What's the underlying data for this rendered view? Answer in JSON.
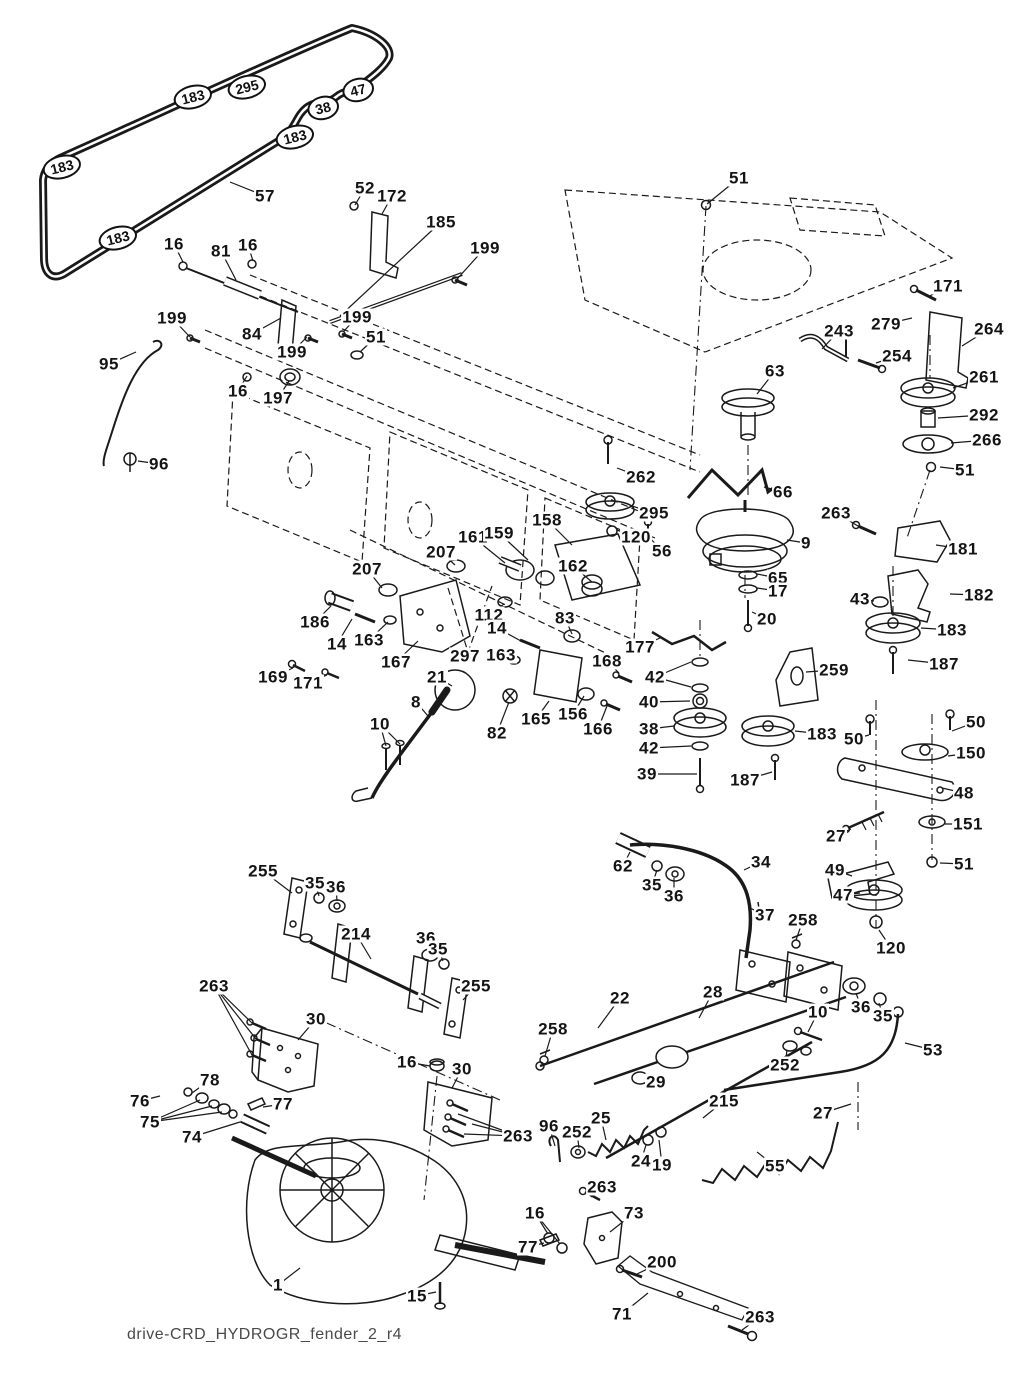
{
  "footer_text": "drive-CRD_HYDROGR_fender_2_r4",
  "colors": {
    "ink": "#1a1a1a",
    "label": "#141414",
    "footer": "#4a4a4a",
    "background": "#ffffff"
  },
  "diagram": {
    "belt_badges": [
      {
        "t": "183",
        "x": 193,
        "y": 97
      },
      {
        "t": "295",
        "x": 247,
        "y": 87
      },
      {
        "t": "47",
        "x": 358,
        "y": 90
      },
      {
        "t": "38",
        "x": 323,
        "y": 108
      },
      {
        "t": "183",
        "x": 295,
        "y": 137
      },
      {
        "t": "183",
        "x": 62,
        "y": 167
      },
      {
        "t": "183",
        "x": 118,
        "y": 238
      }
    ],
    "part_labels": [
      {
        "t": "57",
        "x": 265,
        "y": 196,
        "l": [
          230,
          182
        ]
      },
      {
        "t": "52",
        "x": 365,
        "y": 188,
        "l": [
          355,
          205
        ]
      },
      {
        "t": "172",
        "x": 392,
        "y": 196,
        "l": [
          382,
          214
        ]
      },
      {
        "t": "185",
        "x": 441,
        "y": 222,
        "l": [
          340,
          316
        ]
      },
      {
        "t": "199",
        "x": 485,
        "y": 248,
        "l": [
          458,
          278
        ]
      },
      {
        "t": "51",
        "x": 739,
        "y": 178,
        "l": [
          707,
          204
        ]
      },
      {
        "t": "16",
        "x": 174,
        "y": 244,
        "l": [
          183,
          262
        ]
      },
      {
        "t": "81",
        "x": 221,
        "y": 251,
        "l": [
          236,
          280
        ]
      },
      {
        "t": "16",
        "x": 248,
        "y": 245,
        "l": [
          253,
          261
        ]
      },
      {
        "t": "199",
        "x": 172,
        "y": 318,
        "l": [
          190,
          337
        ]
      },
      {
        "t": "84",
        "x": 252,
        "y": 334,
        "l": [
          281,
          318
        ]
      },
      {
        "t": "199",
        "x": 292,
        "y": 352,
        "l": [
          307,
          337
        ]
      },
      {
        "t": "199",
        "x": 357,
        "y": 317,
        "l": [
          344,
          331
        ]
      },
      {
        "t": "51",
        "x": 376,
        "y": 337,
        "l": [
          360,
          352
        ]
      },
      {
        "t": "95",
        "x": 109,
        "y": 364,
        "l": [
          136,
          352
        ]
      },
      {
        "t": "16",
        "x": 238,
        "y": 391,
        "l": [
          247,
          376
        ]
      },
      {
        "t": "197",
        "x": 278,
        "y": 398,
        "l": [
          289,
          381
        ]
      },
      {
        "t": "96",
        "x": 159,
        "y": 464,
        "l": [
          138,
          461
        ]
      },
      {
        "t": "171",
        "x": 948,
        "y": 286,
        "l": [
          928,
          297
        ]
      },
      {
        "t": "279",
        "x": 886,
        "y": 324,
        "l": [
          912,
          318
        ]
      },
      {
        "t": "264",
        "x": 989,
        "y": 329,
        "l": [
          962,
          346
        ]
      },
      {
        "t": "243",
        "x": 839,
        "y": 331,
        "l": [
          822,
          349
        ]
      },
      {
        "t": "254",
        "x": 897,
        "y": 356,
        "l": [
          876,
          363
        ]
      },
      {
        "t": "63",
        "x": 775,
        "y": 371,
        "l": [
          757,
          394
        ]
      },
      {
        "t": "261",
        "x": 984,
        "y": 377,
        "l": [
          953,
          388
        ]
      },
      {
        "t": "292",
        "x": 984,
        "y": 415,
        "l": [
          938,
          418
        ]
      },
      {
        "t": "266",
        "x": 987,
        "y": 440,
        "l": [
          951,
          443
        ]
      },
      {
        "t": "51",
        "x": 965,
        "y": 470,
        "l": [
          940,
          467
        ]
      },
      {
        "t": "262",
        "x": 641,
        "y": 477,
        "l": [
          617,
          468
        ]
      },
      {
        "t": "295",
        "x": 654,
        "y": 513,
        "l": [
          632,
          506
        ]
      },
      {
        "t": "120",
        "x": 636,
        "y": 537,
        "l": [
          617,
          530
        ]
      },
      {
        "t": "56",
        "x": 662,
        "y": 551,
        "l": [
          649,
          537
        ]
      },
      {
        "t": "66",
        "x": 783,
        "y": 492,
        "l": [
          764,
          487
        ]
      },
      {
        "t": "9",
        "x": 806,
        "y": 543,
        "l": [
          787,
          540
        ]
      },
      {
        "t": "263",
        "x": 836,
        "y": 513,
        "l": [
          858,
          526
        ]
      },
      {
        "t": "181",
        "x": 963,
        "y": 549,
        "l": [
          936,
          545
        ]
      },
      {
        "t": "65",
        "x": 778,
        "y": 578,
        "l": [
          757,
          574
        ]
      },
      {
        "t": "17",
        "x": 778,
        "y": 591,
        "l": [
          757,
          588
        ]
      },
      {
        "t": "20",
        "x": 767,
        "y": 619,
        "l": [
          752,
          612
        ]
      },
      {
        "t": "43",
        "x": 860,
        "y": 599,
        "l": [
          874,
          601
        ]
      },
      {
        "t": "182",
        "x": 979,
        "y": 595,
        "l": [
          950,
          594
        ]
      },
      {
        "t": "183",
        "x": 952,
        "y": 630,
        "l": [
          921,
          628
        ]
      },
      {
        "t": "187",
        "x": 944,
        "y": 664,
        "l": [
          908,
          660
        ]
      },
      {
        "t": "158",
        "x": 547,
        "y": 520,
        "l": [
          572,
          545
        ]
      },
      {
        "t": "161",
        "x": 473,
        "y": 537,
        "l": [
          505,
          563
        ]
      },
      {
        "t": "159",
        "x": 499,
        "y": 533,
        "l": [
          528,
          560
        ]
      },
      {
        "t": "207",
        "x": 441,
        "y": 552,
        "l": [
          455,
          565
        ]
      },
      {
        "t": "162",
        "x": 573,
        "y": 566,
        "l": [
          592,
          582
        ]
      },
      {
        "t": "207",
        "x": 367,
        "y": 569,
        "l": [
          382,
          588
        ]
      },
      {
        "t": "186",
        "x": 315,
        "y": 622,
        "l": [
          331,
          606
        ]
      },
      {
        "t": "14",
        "x": 337,
        "y": 644,
        "l": [
          352,
          619
        ]
      },
      {
        "t": "163",
        "x": 369,
        "y": 640,
        "l": [
          388,
          622
        ]
      },
      {
        "t": "167",
        "x": 396,
        "y": 662,
        "l": [
          418,
          641
        ]
      },
      {
        "t": "297",
        "x": 465,
        "y": 656
      },
      {
        "t": "112",
        "x": 489,
        "y": 615,
        "l": [
          504,
          604
        ]
      },
      {
        "t": "14",
        "x": 497,
        "y": 628,
        "l": [
          521,
          641
        ]
      },
      {
        "t": "163",
        "x": 501,
        "y": 655,
        "l": [
          516,
          660
        ]
      },
      {
        "t": "83",
        "x": 565,
        "y": 618,
        "l": [
          572,
          634
        ]
      },
      {
        "t": "169",
        "x": 273,
        "y": 677,
        "l": [
          293,
          668
        ]
      },
      {
        "t": "171",
        "x": 308,
        "y": 683,
        "l": [
          327,
          675
        ]
      },
      {
        "t": "21",
        "x": 437,
        "y": 677,
        "l": [
          452,
          686
        ]
      },
      {
        "t": "8",
        "x": 416,
        "y": 702,
        "l": [
          428,
          716
        ]
      },
      {
        "t": "10",
        "x": 380,
        "y": 724,
        "l": [
          [
            386,
            746
          ],
          [
            400,
            744
          ]
        ]
      },
      {
        "t": "82",
        "x": 497,
        "y": 733,
        "l": [
          509,
          702
        ]
      },
      {
        "t": "165",
        "x": 536,
        "y": 719,
        "l": [
          549,
          701
        ]
      },
      {
        "t": "156",
        "x": 573,
        "y": 714,
        "l": [
          584,
          696
        ]
      },
      {
        "t": "166",
        "x": 598,
        "y": 729,
        "l": [
          607,
          706
        ]
      },
      {
        "t": "168",
        "x": 607,
        "y": 661,
        "l": [
          619,
          673
        ]
      },
      {
        "t": "177",
        "x": 640,
        "y": 647,
        "l": [
          660,
          638
        ]
      },
      {
        "t": "42",
        "x": 655,
        "y": 677,
        "l": [
          [
            691,
            662
          ],
          [
            691,
            687
          ]
        ]
      },
      {
        "t": "40",
        "x": 649,
        "y": 702,
        "l": [
          690,
          701
        ]
      },
      {
        "t": "38",
        "x": 649,
        "y": 729,
        "l": [
          674,
          726
        ]
      },
      {
        "t": "42",
        "x": 649,
        "y": 748,
        "l": [
          691,
          746
        ]
      },
      {
        "t": "39",
        "x": 647,
        "y": 774,
        "l": [
          697,
          774
        ]
      },
      {
        "t": "259",
        "x": 834,
        "y": 670,
        "l": [
          806,
          672
        ]
      },
      {
        "t": "183",
        "x": 822,
        "y": 734,
        "l": [
          795,
          731
        ]
      },
      {
        "t": "187",
        "x": 745,
        "y": 780,
        "l": [
          772,
          772
        ]
      },
      {
        "t": "50",
        "x": 854,
        "y": 739,
        "l": [
          869,
          735
        ]
      },
      {
        "t": "50",
        "x": 976,
        "y": 722,
        "l": [
          952,
          731
        ]
      },
      {
        "t": "150",
        "x": 971,
        "y": 753,
        "l": [
          948,
          756
        ]
      },
      {
        "t": "48",
        "x": 964,
        "y": 793,
        "l": [
          942,
          788
        ]
      },
      {
        "t": "27",
        "x": 836,
        "y": 836,
        "l": [
          851,
          829
        ]
      },
      {
        "t": "151",
        "x": 968,
        "y": 824,
        "l": [
          945,
          824
        ]
      },
      {
        "t": "49",
        "x": 835,
        "y": 870,
        "l": [
          852,
          876
        ]
      },
      {
        "t": "47",
        "x": 843,
        "y": 895,
        "l": [
          860,
          893
        ]
      },
      {
        "t": "51",
        "x": 964,
        "y": 864,
        "l": [
          940,
          863
        ]
      },
      {
        "t": "62",
        "x": 623,
        "y": 866,
        "l": [
          630,
          852
        ]
      },
      {
        "t": "35",
        "x": 652,
        "y": 885,
        "l": [
          657,
          870
        ]
      },
      {
        "t": "36",
        "x": 674,
        "y": 896,
        "l": [
          674,
          878
        ]
      },
      {
        "t": "34",
        "x": 761,
        "y": 862,
        "l": [
          744,
          870
        ]
      },
      {
        "t": "37",
        "x": 765,
        "y": 915,
        "l": [
          750,
          908
        ]
      },
      {
        "t": "258",
        "x": 803,
        "y": 920,
        "l": [
          796,
          940
        ]
      },
      {
        "t": "120",
        "x": 891,
        "y": 948,
        "l": [
          879,
          930
        ]
      },
      {
        "t": "36",
        "x": 861,
        "y": 1007,
        "l": [
          856,
          993
        ]
      },
      {
        "t": "35",
        "x": 883,
        "y": 1016,
        "l": [
          879,
          1003
        ]
      },
      {
        "t": "10",
        "x": 818,
        "y": 1012,
        "l": [
          808,
          1032
        ]
      },
      {
        "t": "53",
        "x": 933,
        "y": 1050,
        "l": [
          905,
          1043
        ]
      },
      {
        "t": "255",
        "x": 263,
        "y": 871,
        "l": [
          292,
          893
        ]
      },
      {
        "t": "35",
        "x": 315,
        "y": 883,
        "l": [
          319,
          896
        ]
      },
      {
        "t": "36",
        "x": 336,
        "y": 887,
        "l": [
          337,
          901
        ]
      },
      {
        "t": "214",
        "x": 356,
        "y": 934,
        "l": [
          371,
          959
        ]
      },
      {
        "t": "36",
        "x": 426,
        "y": 938,
        "l": [
          429,
          952
        ]
      },
      {
        "t": "35",
        "x": 438,
        "y": 949,
        "l": [
          443,
          961
        ]
      },
      {
        "t": "255",
        "x": 476,
        "y": 986,
        "l": [
          463,
          1000
        ]
      },
      {
        "t": "263",
        "x": 214,
        "y": 986,
        "l": [
          [
            252,
            1023
          ],
          [
            256,
            1039
          ],
          [
            252,
            1055
          ]
        ]
      },
      {
        "t": "30",
        "x": 316,
        "y": 1019,
        "l": [
          298,
          1040
        ]
      },
      {
        "t": "22",
        "x": 620,
        "y": 998,
        "l": [
          598,
          1028
        ]
      },
      {
        "t": "28",
        "x": 713,
        "y": 992,
        "l": [
          699,
          1018
        ]
      },
      {
        "t": "258",
        "x": 553,
        "y": 1029,
        "l": [
          545,
          1056
        ]
      },
      {
        "t": "29",
        "x": 656,
        "y": 1082,
        "l": [
          645,
          1078
        ]
      },
      {
        "t": "252",
        "x": 785,
        "y": 1065,
        "l": [
          787,
          1050
        ]
      },
      {
        "t": "215",
        "x": 724,
        "y": 1101,
        "l": [
          703,
          1118
        ]
      },
      {
        "t": "27",
        "x": 823,
        "y": 1113,
        "l": [
          851,
          1104
        ]
      },
      {
        "t": "16",
        "x": 407,
        "y": 1062,
        "l": [
          430,
          1066
        ]
      },
      {
        "t": "30",
        "x": 462,
        "y": 1069,
        "l": [
          452,
          1088
        ]
      },
      {
        "t": "78",
        "x": 210,
        "y": 1080,
        "l": [
          192,
          1093
        ]
      },
      {
        "t": "76",
        "x": 140,
        "y": 1101,
        "l": [
          160,
          1096
        ]
      },
      {
        "t": "77",
        "x": 283,
        "y": 1104,
        "l": [
          263,
          1107
        ]
      },
      {
        "t": "75",
        "x": 150,
        "y": 1122,
        "l": [
          [
            200,
            1100
          ],
          [
            212,
            1106
          ],
          [
            222,
            1112
          ]
        ]
      },
      {
        "t": "74",
        "x": 192,
        "y": 1137,
        "l": [
          240,
          1122
        ]
      },
      {
        "t": "263",
        "x": 518,
        "y": 1136,
        "l": [
          [
            458,
            1114
          ],
          [
            472,
            1124
          ],
          [
            464,
            1134
          ]
        ]
      },
      {
        "t": "96",
        "x": 549,
        "y": 1126,
        "l": [
          555,
          1146
        ]
      },
      {
        "t": "252",
        "x": 577,
        "y": 1132,
        "l": [
          579,
          1148
        ]
      },
      {
        "t": "25",
        "x": 601,
        "y": 1118,
        "l": [
          606,
          1140
        ]
      },
      {
        "t": "24",
        "x": 641,
        "y": 1161,
        "l": [
          646,
          1145
        ]
      },
      {
        "t": "19",
        "x": 662,
        "y": 1165,
        "l": [
          659,
          1140
        ]
      },
      {
        "t": "55",
        "x": 775,
        "y": 1166,
        "l": [
          757,
          1152
        ]
      },
      {
        "t": "263",
        "x": 602,
        "y": 1187,
        "l": [
          591,
          1197
        ]
      },
      {
        "t": "16",
        "x": 535,
        "y": 1213,
        "l": [
          [
            548,
            1234
          ],
          [
            560,
            1244
          ]
        ]
      },
      {
        "t": "73",
        "x": 634,
        "y": 1213,
        "l": [
          610,
          1232
        ]
      },
      {
        "t": "77",
        "x": 528,
        "y": 1247,
        "l": [
          544,
          1243
        ]
      },
      {
        "t": "200",
        "x": 662,
        "y": 1262,
        "l": [
          637,
          1274
        ]
      },
      {
        "t": "71",
        "x": 622,
        "y": 1314,
        "l": [
          648,
          1293
        ]
      },
      {
        "t": "263",
        "x": 760,
        "y": 1317,
        "l": [
          742,
          1330
        ]
      },
      {
        "t": "1",
        "x": 278,
        "y": 1285,
        "l": [
          300,
          1268
        ]
      },
      {
        "t": "15",
        "x": 417,
        "y": 1296,
        "l": [
          436,
          1292
        ]
      }
    ]
  }
}
